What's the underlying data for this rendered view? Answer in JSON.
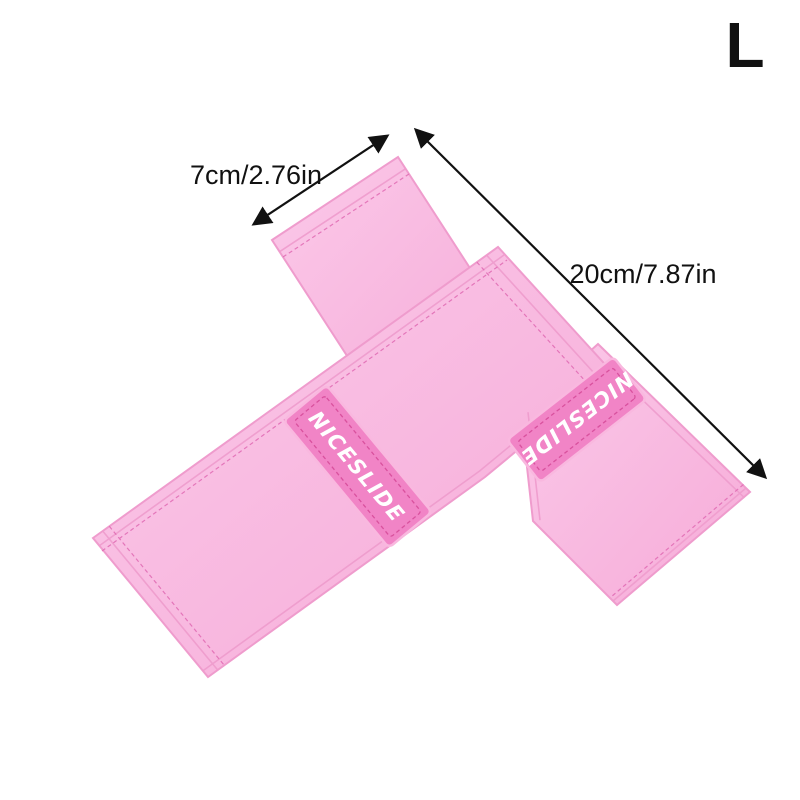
{
  "size_label": "L",
  "brand": "NICESLIDE",
  "dimensions": {
    "width_label": "7cm/2.76in",
    "length_label": "20cm/7.87in"
  },
  "colors": {
    "background": "#ffffff",
    "ink": "#111111",
    "band_light": "#fbc9e9",
    "band": "#f6abd8",
    "band_edge": "#ef9ccd",
    "stitch": "#e06ab3",
    "patch": "#f184c6",
    "patch_edge": "#f9b8df",
    "patch_stitch": "#d9519e",
    "brand_text": "#ffffff"
  }
}
